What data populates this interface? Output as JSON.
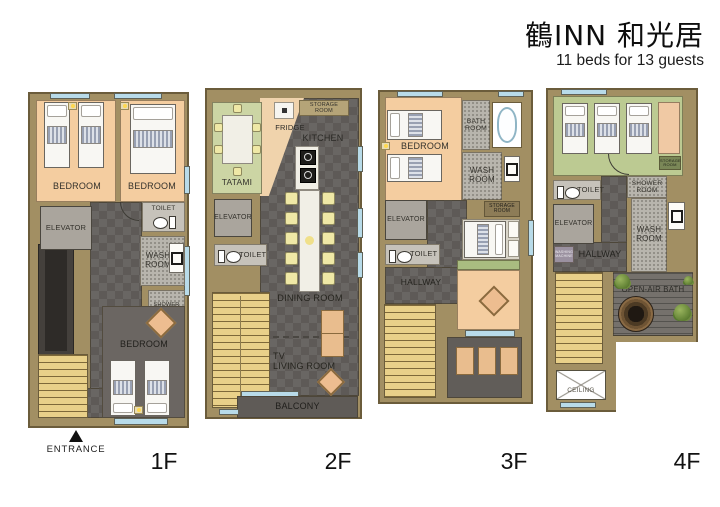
{
  "header": {
    "title": "鶴INN 和光居",
    "subtitle": "11 beds for 13 guests"
  },
  "entrance": {
    "label": "ENTRANCE"
  },
  "floors": [
    {
      "label": "1F",
      "rooms": {
        "bedroom_a": "BEDROOM",
        "bedroom_b": "BEDROOM",
        "elevator": "ELEVATOR",
        "toilet": "TOILET",
        "wash_room": "WASH ROOM",
        "shower_room": "SHOWER ROOM",
        "bedroom_c": "BEDROOM"
      }
    },
    {
      "label": "2F",
      "rooms": {
        "tatami": "TATAMI",
        "storage_room": "STORAGE ROOM",
        "fridge": "FRIDGE",
        "kitchen": "KITCHEN",
        "elevator": "ELEVATOR",
        "toilet": "TOILET",
        "dining_room": "DINING ROOM",
        "tv": "TV",
        "living_room": "LIVING ROOM",
        "balcony": "BALCONY"
      }
    },
    {
      "label": "3F",
      "rooms": {
        "bedroom_a": "BEDROOM",
        "bath_room": "BATH ROOM",
        "wash_room": "WASH ROOM",
        "elevator": "ELEVATOR",
        "toilet": "TOILET",
        "storage_room": "STORAGE ROOM",
        "hallway": "HALLWAY"
      }
    },
    {
      "label": "4F",
      "rooms": {
        "toilet": "TOILET",
        "elevator": "ELEVATOR",
        "shower_room": "SHOWER ROOM",
        "wash_room": "WASH ROOM",
        "hallway": "HALLWAY",
        "washing_machine": "WASHING MACHINE",
        "storage_room": "STORAGE ROOM",
        "open_air_bath": "OPEN-AIR BATH",
        "ceiling": "CEILING"
      }
    }
  ]
}
